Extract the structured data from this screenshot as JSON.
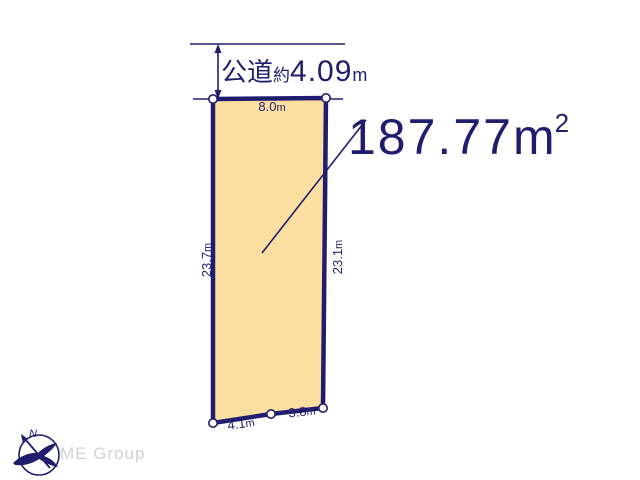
{
  "diagram": {
    "road": {
      "name": "公道",
      "approx": "約",
      "width_value": "4.09",
      "unit": "m"
    },
    "area": {
      "value": "187.77",
      "unit": "m",
      "exponent": "2"
    },
    "dimensions": {
      "top": {
        "value": "8.0",
        "unit": "m"
      },
      "left": {
        "value": "23.7",
        "unit": "m"
      },
      "right": {
        "value": "23.1",
        "unit": "m"
      },
      "bottom_left": {
        "value": "4.1",
        "unit": "m"
      },
      "bottom_right": {
        "value": "3.8",
        "unit": "m"
      }
    },
    "compass": {
      "north": "N"
    },
    "branding": {
      "watermark": "ME Group"
    },
    "colors": {
      "line_navy": "#211d6e",
      "parcel_fill": "#fbdfa1",
      "watermark_gray": "#d2d2d2"
    }
  }
}
